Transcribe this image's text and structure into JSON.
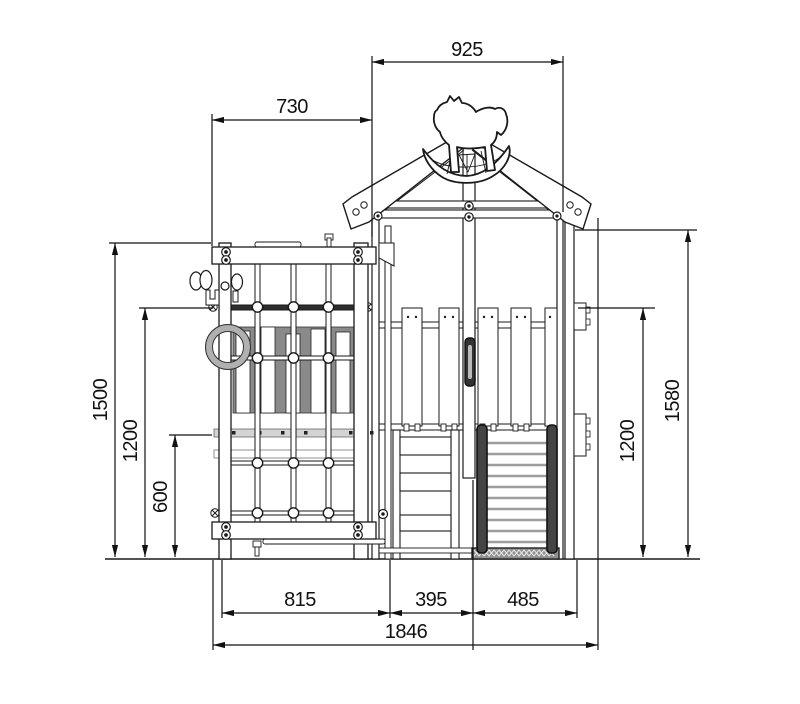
{
  "drawing": {
    "dims": {
      "roof_width": "925",
      "net_frame_width": "730",
      "net_frame_height": "1500",
      "net_rail_height": "1200",
      "holds_band_height": "600",
      "tower_height": "1580",
      "tower_rail_height": "1200",
      "net_base_width": "815",
      "steps_width": "395",
      "ramp_width": "485",
      "total_width": "1846"
    },
    "colors": {
      "line": "#1a1a1a",
      "paper": "#ffffff",
      "shade": "#8a8a8a",
      "dark_rail": "#2e2e2e"
    }
  }
}
